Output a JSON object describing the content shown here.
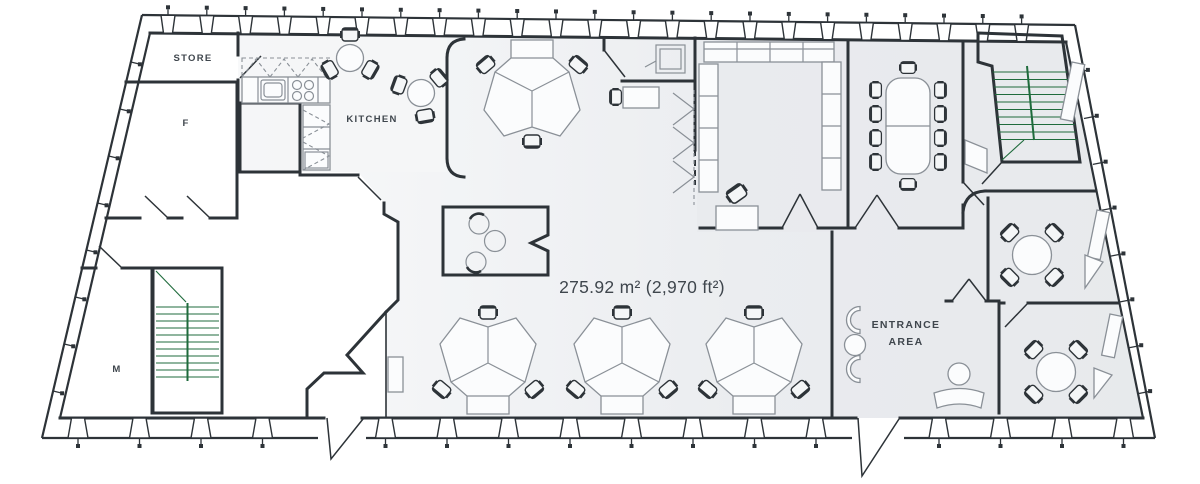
{
  "labels": {
    "store": "STORE",
    "toilet_f": "F",
    "toilet_m": "M",
    "kitchen": "KITCHEN",
    "entrance_line1": "ENTRANCE",
    "entrance_line2": "AREA",
    "area": "275.92 m² (2,970 ft²)"
  },
  "colors": {
    "wall": "#2d3338",
    "furniture": "#8a9097",
    "text": "#3f464d",
    "green": "#2ca45a",
    "floor_light": "#f8f9fa",
    "floor_gray": "#e8ebee",
    "floor_right": "#e7eaed",
    "kitchen_floor": "#f4f6f7",
    "white": "#ffffff"
  }
}
